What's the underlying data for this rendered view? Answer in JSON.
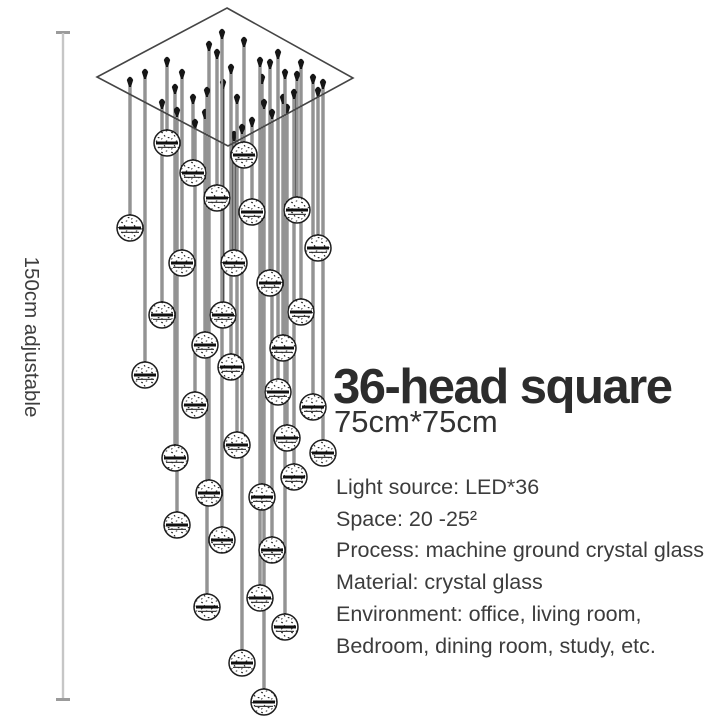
{
  "dimension_label": "150cm adjustable",
  "product": {
    "title": "36-head square",
    "size": "75cm*75cm",
    "specs": [
      "Light source: LED*36",
      "Space: 20 -25²",
      "Process: machine ground crystal glass",
      "Material: crystal glass",
      "Environment: office, living room,",
      "Bedroom, dining room, study, etc."
    ]
  },
  "illustration": {
    "canopy_points": "227,8 353,78 228,146 97,77",
    "ball_radius": 13,
    "wire_color": "#3b3b3b",
    "ball_stroke": "#1e1e1e",
    "band_color": "#101010",
    "cone_color": "#161616",
    "canopy_stroke": "#454545",
    "measure_line_color": "#c6c6c6",
    "measure_cap_color": "#9b9b9b",
    "wires": [
      [
        167,
        58,
        143
      ],
      [
        244,
        38,
        155
      ],
      [
        193,
        95,
        173
      ],
      [
        217,
        50,
        198
      ],
      [
        297,
        72,
        210
      ],
      [
        252,
        118,
        212
      ],
      [
        130,
        78,
        228
      ],
      [
        318,
        88,
        248
      ],
      [
        182,
        70,
        263
      ],
      [
        234,
        132,
        263
      ],
      [
        270,
        60,
        283
      ],
      [
        301,
        60,
        312
      ],
      [
        162,
        100,
        315
      ],
      [
        223,
        80,
        315
      ],
      [
        205,
        110,
        345
      ],
      [
        283,
        95,
        348
      ],
      [
        231,
        65,
        367
      ],
      [
        145,
        70,
        375
      ],
      [
        278,
        50,
        392
      ],
      [
        195,
        120,
        405
      ],
      [
        313,
        75,
        407
      ],
      [
        287,
        105,
        438
      ],
      [
        237,
        95,
        445
      ],
      [
        323,
        80,
        453
      ],
      [
        175,
        85,
        458
      ],
      [
        294,
        90,
        477
      ],
      [
        209,
        42,
        493
      ],
      [
        262,
        75,
        497
      ],
      [
        177,
        108,
        525
      ],
      [
        222,
        30,
        540
      ],
      [
        272,
        110,
        550
      ],
      [
        260,
        58,
        598
      ],
      [
        207,
        88,
        607
      ],
      [
        285,
        70,
        627
      ],
      [
        242,
        125,
        663
      ],
      [
        264,
        100,
        702
      ]
    ]
  }
}
